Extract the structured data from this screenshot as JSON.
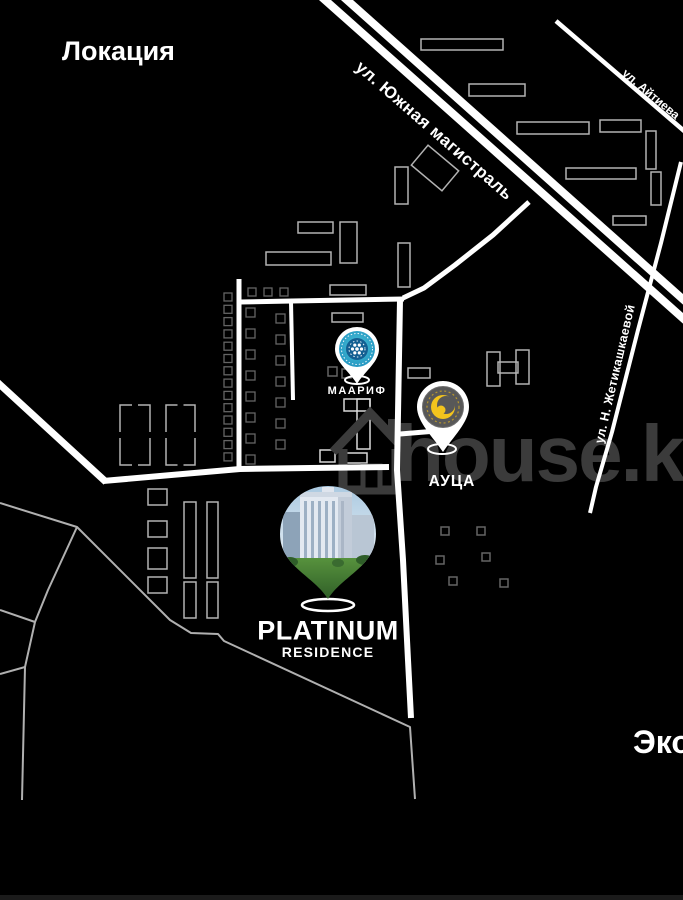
{
  "title": "Локация",
  "edge_label": "Эко",
  "watermark": {
    "text": "house.kg",
    "icon": "house-icon",
    "color": "#3b3b3b"
  },
  "streets": {
    "south_highway": "ул. Южная магистраль",
    "aytieva": "ул. Айтиева",
    "zhetikashkaeva": "ул. Н. Жетикашкаевой"
  },
  "pins": {
    "maarif": {
      "label": "МААРИФ",
      "logo_colors": [
        "#35b6cd",
        "#135f92",
        "#ffffff"
      ]
    },
    "auca": {
      "label": "АУЦА",
      "logo_colors": [
        "#585858",
        "#f2c41d"
      ]
    },
    "platinum": {
      "title": "PLATINUM",
      "subtitle": "RESIDENCE"
    }
  },
  "colors": {
    "background": "#000000",
    "road_main": "#ffffff",
    "road_thin": "#b0b0b0",
    "building_mid": "#b2b2b2",
    "building_bright": "#d9d9d9",
    "building_dim": "#646464",
    "text": "#ffffff"
  },
  "map": {
    "roads": [
      {
        "name": "south-highway-line-1",
        "points": [
          [
            316,
            -8
          ],
          [
            686,
            321
          ]
        ],
        "w": 8,
        "c": "#ffffff"
      },
      {
        "name": "south-highway-line-2",
        "points": [
          [
            338,
            -8
          ],
          [
            686,
            302
          ]
        ],
        "w": 8,
        "c": "#ffffff"
      },
      {
        "name": "aytieva-road",
        "points": [
          [
            556,
            21
          ],
          [
            690,
            136
          ]
        ],
        "w": 4.5,
        "c": "#ffffff"
      },
      {
        "name": "curve-to-highway",
        "points": [
          [
            529,
            202
          ],
          [
            493,
            235
          ],
          [
            455,
            265
          ],
          [
            424,
            288
          ],
          [
            403,
            298
          ]
        ],
        "w": 5,
        "c": "#ffffff"
      },
      {
        "name": "mid-horizontal-road",
        "points": [
          [
            404,
            299
          ],
          [
            292,
            301
          ],
          [
            240,
            302
          ]
        ],
        "w": 5,
        "c": "#ffffff"
      },
      {
        "name": "left-vertical-road",
        "points": [
          [
            239,
            279
          ],
          [
            239,
            469
          ]
        ],
        "w": 5,
        "c": "#ffffff"
      },
      {
        "name": "mid-vertical-stub",
        "points": [
          [
            291,
            302
          ],
          [
            293,
            400
          ]
        ],
        "w": 4,
        "c": "#ffffff"
      },
      {
        "name": "lower-horizontal-road",
        "points": [
          [
            103,
            481
          ],
          [
            240,
            469
          ],
          [
            310,
            468
          ],
          [
            389,
            467
          ]
        ],
        "w": 6,
        "c": "#ffffff"
      },
      {
        "name": "left-diagonal-road",
        "points": [
          [
            -4,
            381
          ],
          [
            106,
            482
          ]
        ],
        "w": 7,
        "c": "#ffffff"
      },
      {
        "name": "big-vertical-road",
        "points": [
          [
            400,
            300
          ],
          [
            397,
            470
          ],
          [
            403,
            560
          ],
          [
            408,
            660
          ],
          [
            411,
            718
          ]
        ],
        "w": 6,
        "c": "#ffffff"
      },
      {
        "name": "auca-spur",
        "points": [
          [
            400,
            434
          ],
          [
            449,
            430
          ]
        ],
        "w": 5,
        "c": "#ffffff"
      },
      {
        "name": "zhetikashkaeva-road",
        "points": [
          [
            681,
            162
          ],
          [
            661,
            243
          ],
          [
            638,
            330
          ],
          [
            612,
            432
          ],
          [
            596,
            487
          ],
          [
            590,
            513
          ]
        ],
        "w": 4,
        "c": "#ffffff"
      },
      {
        "name": "thin-road-a",
        "points": [
          [
            0,
            503
          ],
          [
            77,
            527
          ],
          [
            170,
            620
          ],
          [
            191,
            633
          ],
          [
            218,
            634
          ],
          [
            224,
            641
          ],
          [
            410,
            727
          ],
          [
            415,
            799
          ]
        ],
        "w": 2,
        "c": "#b0b0b0"
      },
      {
        "name": "thin-road-b",
        "points": [
          [
            77,
            527
          ],
          [
            48,
            590
          ],
          [
            35,
            622
          ],
          [
            25,
            667
          ],
          [
            22,
            800
          ]
        ],
        "w": 2,
        "c": "#b0b0b0"
      },
      {
        "name": "thin-road-c",
        "points": [
          [
            25,
            667
          ],
          [
            0,
            674
          ]
        ],
        "w": 2,
        "c": "#b0b0b0"
      },
      {
        "name": "thin-road-d",
        "points": [
          [
            0,
            610
          ],
          [
            35,
            622
          ]
        ],
        "w": 2,
        "c": "#b0b0b0"
      }
    ],
    "buildings": [
      {
        "type": "rect",
        "x": 421,
        "y": 39,
        "w": 82,
        "h": 11,
        "s": "m"
      },
      {
        "type": "rect",
        "x": 469,
        "y": 84,
        "w": 56,
        "h": 12,
        "s": "m"
      },
      {
        "type": "rect",
        "x": 517,
        "y": 122,
        "w": 72,
        "h": 12,
        "s": "m"
      },
      {
        "type": "rect",
        "x": 600,
        "y": 120,
        "w": 41,
        "h": 12,
        "s": "m"
      },
      {
        "type": "rect",
        "x": 646,
        "y": 131,
        "w": 10,
        "h": 38,
        "s": "m"
      },
      {
        "type": "rect",
        "x": 651,
        "y": 172,
        "w": 10,
        "h": 33,
        "s": "m"
      },
      {
        "type": "rect",
        "x": 566,
        "y": 168,
        "w": 70,
        "h": 11,
        "s": "m"
      },
      {
        "type": "rect",
        "x": 613,
        "y": 216,
        "w": 33,
        "h": 9,
        "s": "m"
      },
      {
        "type": "rect",
        "x": 415,
        "y": 155,
        "w": 40,
        "h": 26,
        "s": "m",
        "r": 40
      },
      {
        "type": "rect",
        "x": 395,
        "y": 167,
        "w": 13,
        "h": 37,
        "s": "m"
      },
      {
        "type": "rect",
        "x": 298,
        "y": 222,
        "w": 35,
        "h": 11,
        "s": "m"
      },
      {
        "type": "rect",
        "x": 340,
        "y": 222,
        "w": 17,
        "h": 41,
        "s": "m"
      },
      {
        "type": "rect",
        "x": 266,
        "y": 252,
        "w": 65,
        "h": 13,
        "s": "m"
      },
      {
        "type": "rect",
        "x": 398,
        "y": 243,
        "w": 12,
        "h": 44,
        "s": "m"
      },
      {
        "type": "rect",
        "x": 330,
        "y": 285,
        "w": 36,
        "h": 10,
        "s": "m"
      },
      {
        "type": "rect",
        "x": 332,
        "y": 313,
        "w": 31,
        "h": 9,
        "s": "m"
      },
      {
        "type": "rect",
        "x": 344,
        "y": 399,
        "w": 26,
        "h": 12,
        "s": "b"
      },
      {
        "type": "rect",
        "x": 357,
        "y": 399,
        "w": 13,
        "h": 50,
        "s": "b"
      },
      {
        "type": "rect",
        "x": 487,
        "y": 352,
        "w": 13,
        "h": 34,
        "s": "m"
      },
      {
        "type": "rect",
        "x": 516,
        "y": 350,
        "w": 13,
        "h": 34,
        "s": "m"
      },
      {
        "type": "rect",
        "x": 498,
        "y": 362,
        "w": 20,
        "h": 11,
        "s": "m"
      },
      {
        "type": "rect",
        "x": 408,
        "y": 368,
        "w": 22,
        "h": 10,
        "s": "m"
      },
      {
        "type": "rect",
        "x": 320,
        "y": 450,
        "w": 15,
        "h": 12,
        "s": "b"
      },
      {
        "type": "rect",
        "x": 340,
        "y": 453,
        "w": 27,
        "h": 10,
        "s": "b"
      },
      {
        "type": "bracket",
        "x": 120,
        "y": 405,
        "w": 30,
        "h": 60,
        "s": "m"
      },
      {
        "type": "bracket",
        "x": 166,
        "y": 405,
        "w": 29,
        "h": 60,
        "s": "m"
      },
      {
        "type": "rect",
        "x": 148,
        "y": 489,
        "w": 19,
        "h": 16,
        "s": "m"
      },
      {
        "type": "rect",
        "x": 148,
        "y": 521,
        "w": 19,
        "h": 16,
        "s": "m"
      },
      {
        "type": "rect",
        "x": 148,
        "y": 548,
        "w": 19,
        "h": 21,
        "s": "m"
      },
      {
        "type": "rect",
        "x": 148,
        "y": 577,
        "w": 19,
        "h": 16,
        "s": "m"
      },
      {
        "type": "rect",
        "x": 184,
        "y": 502,
        "w": 12,
        "h": 76,
        "s": "m"
      },
      {
        "type": "rect",
        "x": 207,
        "y": 502,
        "w": 11,
        "h": 76,
        "s": "m"
      },
      {
        "type": "rect",
        "x": 184,
        "y": 582,
        "w": 12,
        "h": 36,
        "s": "m"
      },
      {
        "type": "rect",
        "x": 207,
        "y": 582,
        "w": 11,
        "h": 36,
        "s": "m"
      },
      {
        "type": "sqcol",
        "x": 224,
        "y0": 293,
        "step": 12.3,
        "n": 14,
        "size": 8,
        "s": "d"
      },
      {
        "type": "sqrow",
        "y": 288,
        "x0": 248,
        "step": 16,
        "n": 3,
        "size": 8,
        "s": "d"
      },
      {
        "type": "sqcol",
        "x": 246,
        "y0": 308,
        "step": 21,
        "n": 8,
        "size": 9,
        "s": "d"
      },
      {
        "type": "sqcol",
        "x": 276,
        "y0": 314,
        "step": 21,
        "n": 7,
        "size": 9,
        "s": "d"
      },
      {
        "type": "rect",
        "x": 328,
        "y": 367,
        "w": 9,
        "h": 9,
        "s": "d"
      },
      {
        "type": "rect",
        "x": 342,
        "y": 369,
        "w": 9,
        "h": 9,
        "s": "d"
      },
      {
        "type": "rect",
        "x": 441,
        "y": 527,
        "w": 8,
        "h": 8,
        "s": "d"
      },
      {
        "type": "rect",
        "x": 477,
        "y": 527,
        "w": 8,
        "h": 8,
        "s": "d"
      },
      {
        "type": "rect",
        "x": 436,
        "y": 556,
        "w": 8,
        "h": 8,
        "s": "d"
      },
      {
        "type": "rect",
        "x": 482,
        "y": 553,
        "w": 8,
        "h": 8,
        "s": "d"
      },
      {
        "type": "rect",
        "x": 449,
        "y": 577,
        "w": 8,
        "h": 8,
        "s": "d"
      },
      {
        "type": "rect",
        "x": 500,
        "y": 579,
        "w": 8,
        "h": 8,
        "s": "d"
      }
    ]
  }
}
